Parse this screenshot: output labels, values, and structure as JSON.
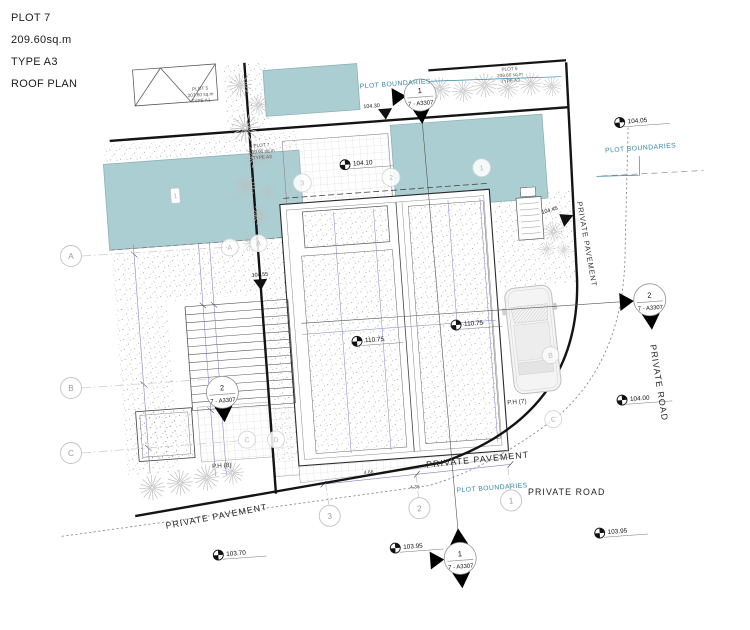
{
  "title_block": {
    "plot": "PLOT 7",
    "area": "209.60sq.m",
    "type": "TYPE A3",
    "view": "ROOF PLAN"
  },
  "colors": {
    "pool": "#abced2",
    "teal_text": "#3488a6",
    "heavy_line": "#141414",
    "dim_line": "#8080c2"
  },
  "boundary_labels": {
    "top": "PLOT BOUNDARIES",
    "right": "PLOT BOUNDARIES",
    "bottom": "PLOT BOUNDARIES"
  },
  "roads": {
    "pavement_bottom_left": "PRIVATE PAVEMENT",
    "pavement_bottom_mid": "PRIVATE PAVEMENT",
    "pavement_right": "PRIVATE PAVEMENT",
    "road_bottom": "PRIVATE ROAD",
    "road_right": "PRIVATE ROAD"
  },
  "penthouse": {
    "ph8": "P.H (8)",
    "ph7": "P.H (7)"
  },
  "plot_tags": {
    "plot5": {
      "name": "PLOT 5",
      "area": "207.60 sq.m",
      "type": "TYPE A1"
    },
    "plot7": {
      "name": "PLOT 7",
      "area": "209.60 sq.m",
      "type": "TYPE A3"
    },
    "plot6": {
      "name": "PLOT 6",
      "area": "209.60 sq.m",
      "type": "TYPE A3"
    }
  },
  "spots": {
    "s104_05": "104.05",
    "s104_10": "104.10",
    "s104_30": "104.30",
    "s110_75a": "110.75",
    "s110_75b": "110.75",
    "s104_00": "104.00",
    "s103_95a": "103.95",
    "s103_95b": "103.95",
    "s103_70": "103.70",
    "s104_55": "104.55",
    "s104_45": "104.45"
  },
  "sections": {
    "top": {
      "num": "1",
      "ref": "7 - A3307"
    },
    "left": {
      "num": "2",
      "ref": "7 - A3307"
    },
    "right": {
      "num": "2",
      "ref": "7 - A3307"
    },
    "bottom": {
      "num": "1",
      "ref": "7 - A3307"
    }
  },
  "grids": {
    "left": {
      "a": "A",
      "b": "B",
      "c": "C"
    },
    "bottom": {
      "g3": "3",
      "g2": "2",
      "g1": "1"
    },
    "top": {
      "g3": "3",
      "g2": "2",
      "g1": "1"
    },
    "faint": {
      "a1": "A",
      "a2": "A",
      "b": "B",
      "c1": "C",
      "c2": "C",
      "d": "D"
    },
    "pool_tag": "1"
  },
  "dims": {
    "d1": "4.66",
    "d2": "4.36"
  }
}
